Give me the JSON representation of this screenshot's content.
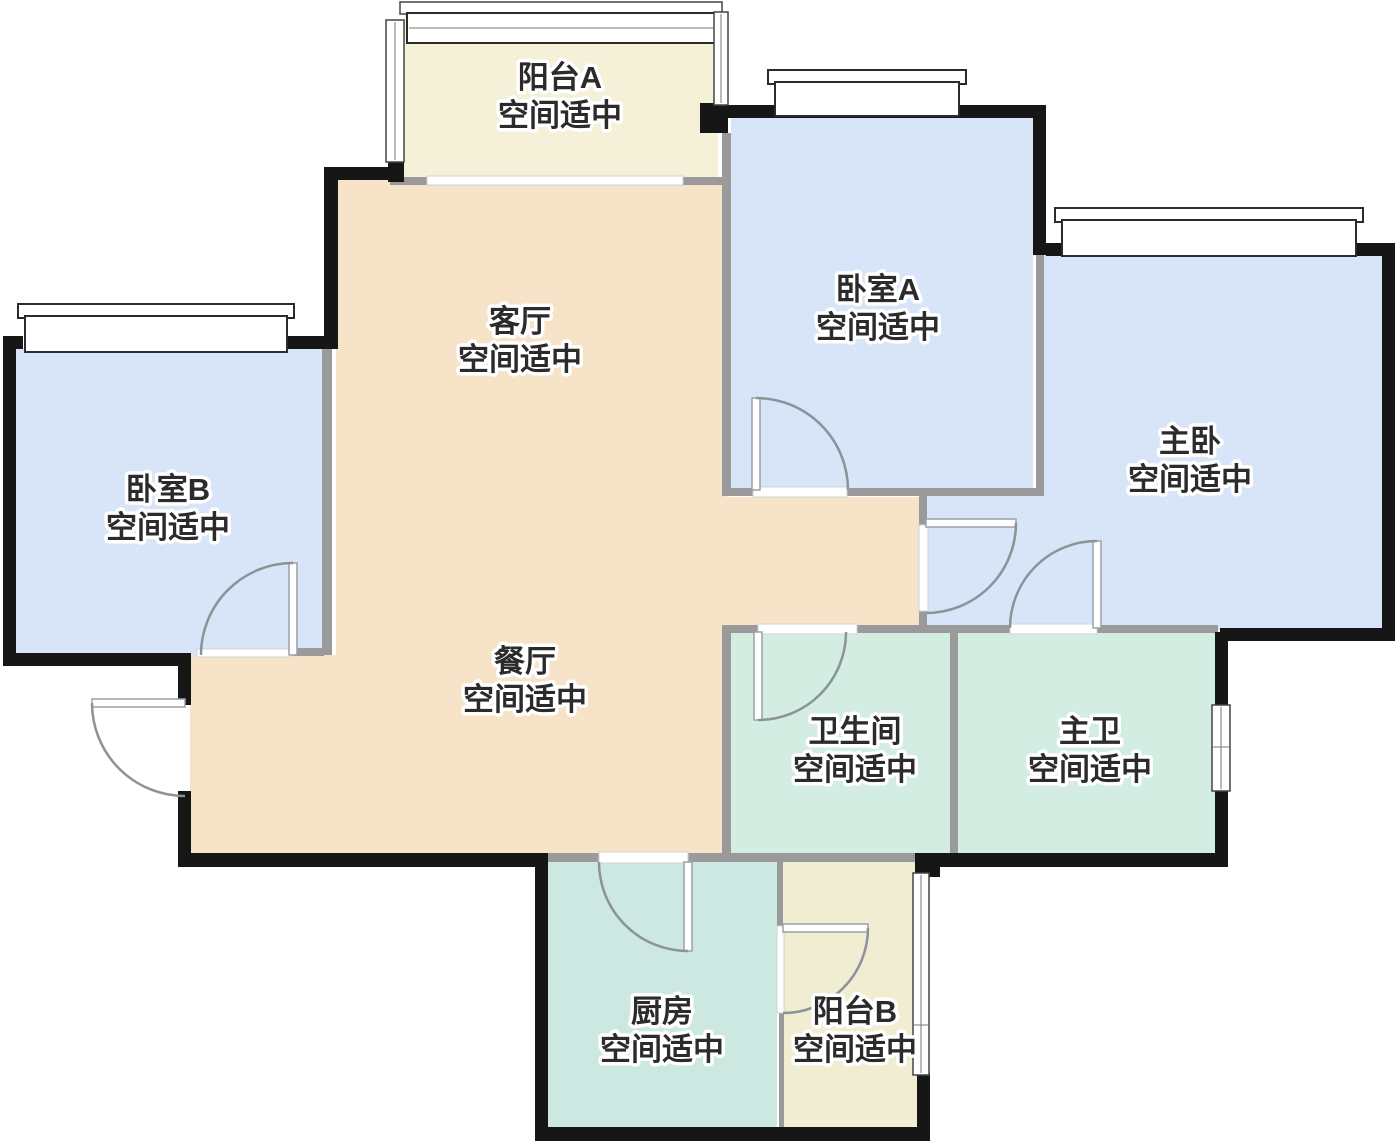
{
  "palette": {
    "wall": "#161616",
    "inner_wall": "#9a9a9a",
    "door": "#8b9298",
    "window_frame": "#2b2b2b",
    "background": "#ffffff",
    "text": "#2b2b2b"
  },
  "rooms": {
    "balcony_a": {
      "name": "阳台A",
      "status": "空间适中",
      "color": "#f4f1d8"
    },
    "bedroom_a": {
      "name": "卧室A",
      "status": "空间适中",
      "color": "#d8e5f9"
    },
    "master_bedroom": {
      "name": "主卧",
      "status": "空间适中",
      "color": "#d8e5f9"
    },
    "bedroom_b": {
      "name": "卧室B",
      "status": "空间适中",
      "color": "#d8e5f9"
    },
    "living": {
      "name": "客厅",
      "status": "空间适中",
      "color": "#f6e3c8"
    },
    "dining": {
      "name": "餐厅",
      "status": "空间适中",
      "color": "#f6e3c8"
    },
    "bathroom": {
      "name": "卫生间",
      "status": "空间适中",
      "color": "#d4ede2"
    },
    "master_bath": {
      "name": "主卫",
      "status": "空间适中",
      "color": "#d4ede2"
    },
    "kitchen": {
      "name": "厨房",
      "status": "空间适中",
      "color": "#cde8e1"
    },
    "balcony_b": {
      "name": "阳台B",
      "status": "空间适中",
      "color": "#f1edd2"
    }
  }
}
